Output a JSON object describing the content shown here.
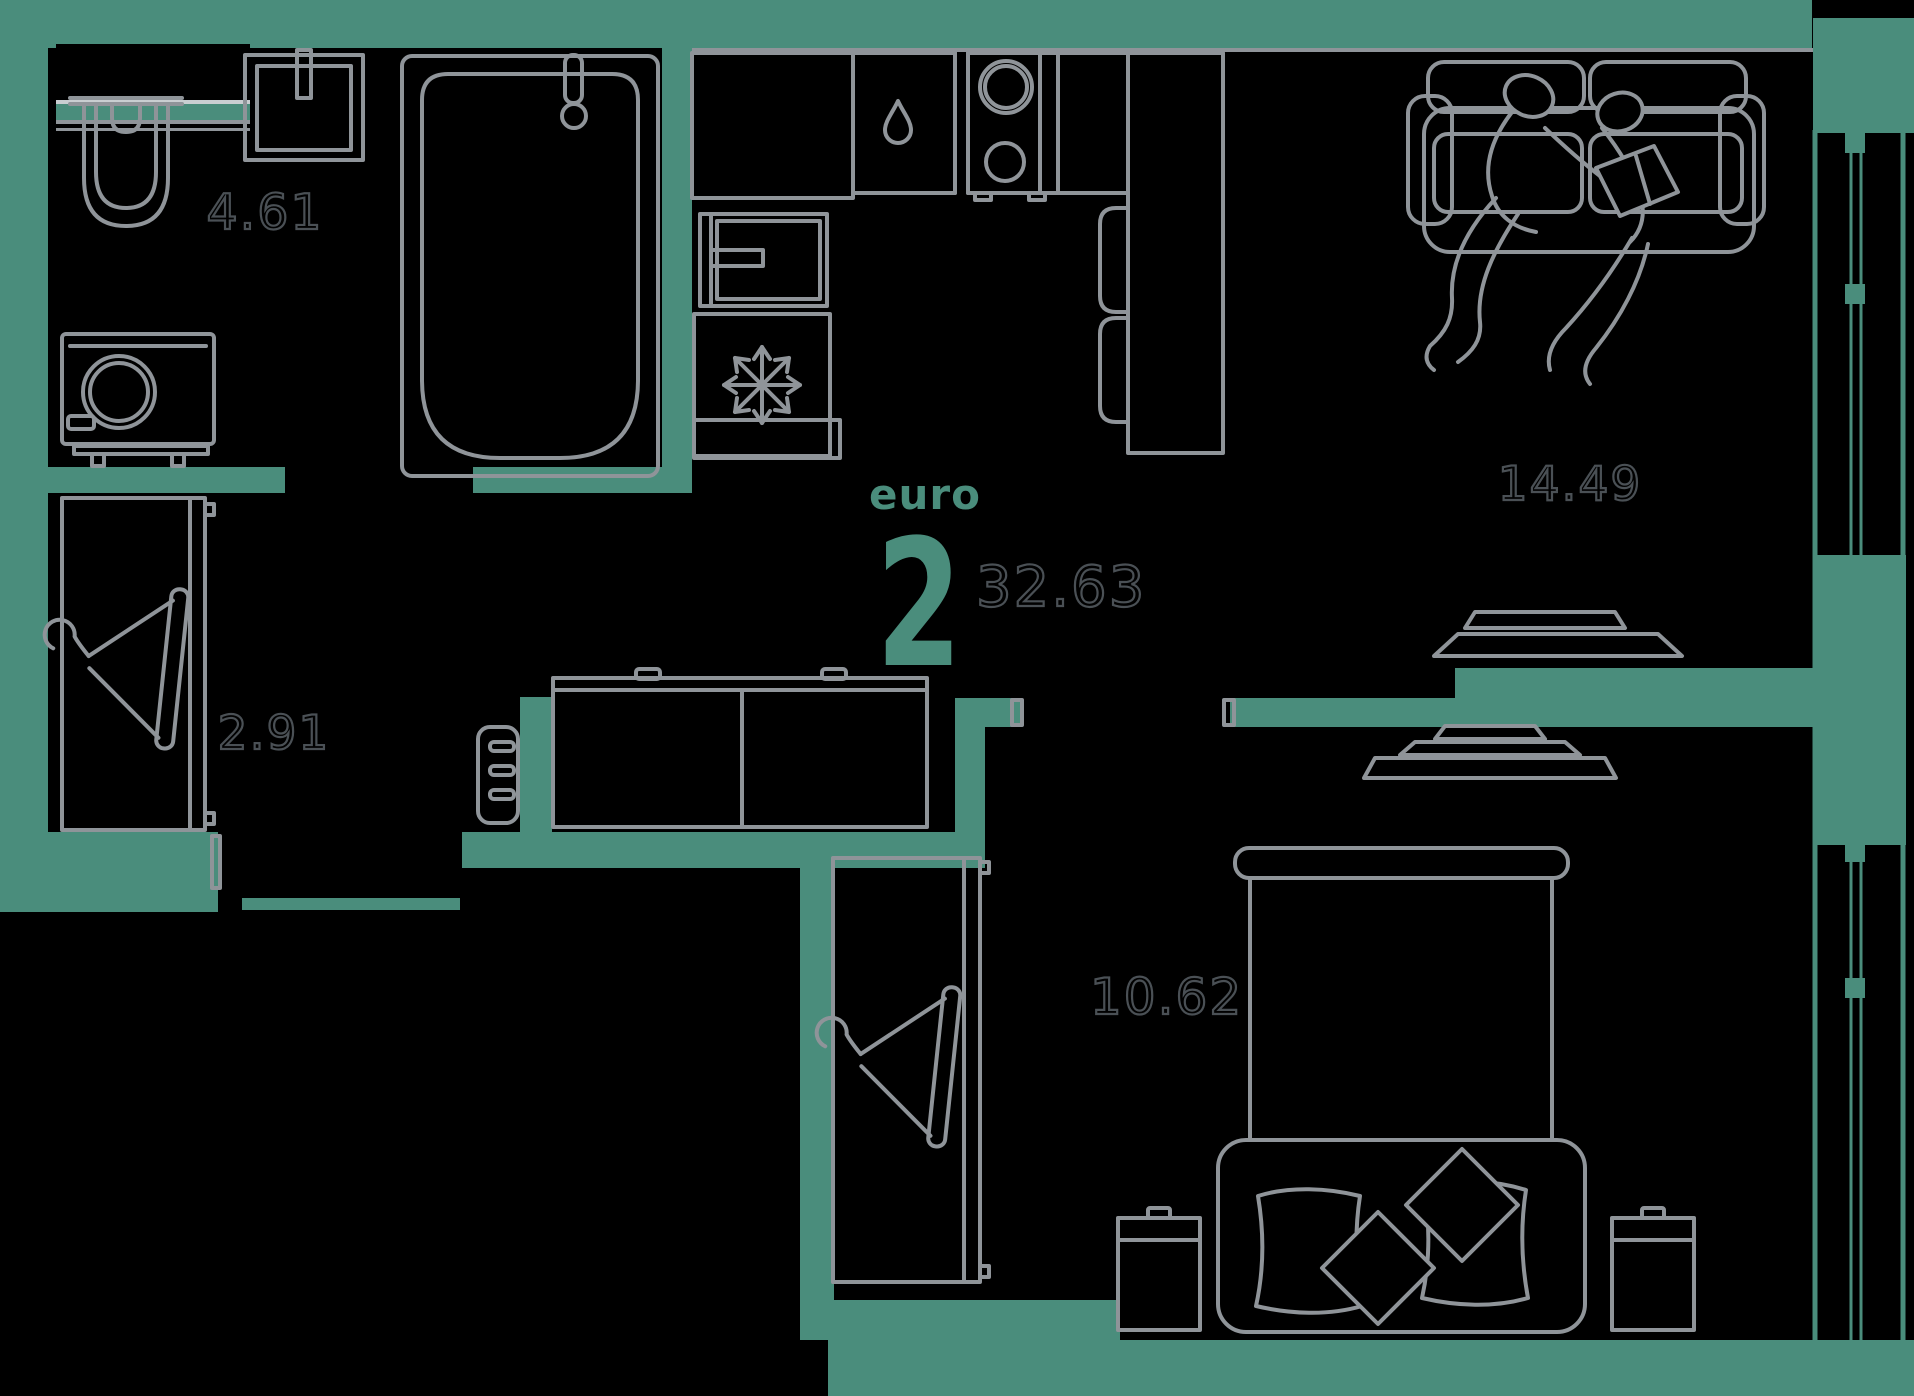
{
  "colors": {
    "background": "#000000",
    "wall": "#4A8D7C",
    "furniture": "#8F9499",
    "label_outline": "#4A5055",
    "accent": "#4A8D7C",
    "window_light": "#C9CED1"
  },
  "unit": {
    "type_label": "euro",
    "rooms_count": "2",
    "total_area": "32.63"
  },
  "rooms": [
    {
      "id": "bathroom",
      "area": "4.61",
      "icons": [
        "toilet-icon",
        "wall-sink-icon",
        "bathtub-icon",
        "washing-machine-icon"
      ]
    },
    {
      "id": "hallway",
      "area": "2.91",
      "icons": [
        "wardrobe-icon",
        "hanger-icon",
        "shoe-bench-icon",
        "entrance-threshold"
      ]
    },
    {
      "id": "kitchen-living",
      "area": "14.49",
      "icons": [
        "kitchen-counter-icon",
        "sink-drop-icon",
        "stove-burners-icon",
        "oven-icon",
        "fridge-snowflake-icon",
        "bar-counter-icon",
        "bar-stool-icon",
        "door-leaf-icon",
        "dresser-icon",
        "sofa-icon",
        "people-reading-icon",
        "ceiling-lamp-icon"
      ]
    },
    {
      "id": "bedroom",
      "area": "10.62",
      "icons": [
        "bed-icon",
        "pillow-icon",
        "nightstand-icon",
        "wardrobe-icon",
        "hanger-icon",
        "ceiling-lamp-icon"
      ]
    }
  ],
  "windows": [
    "living-room-window",
    "bedroom-window"
  ]
}
